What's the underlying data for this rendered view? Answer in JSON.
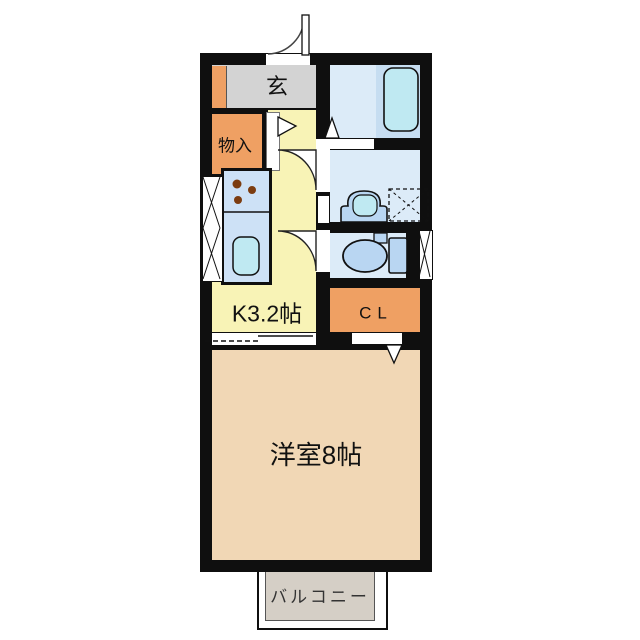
{
  "labels": {
    "genkan": "玄",
    "storage": "物入",
    "kitchen": "K3.2帖",
    "closet": "CL",
    "western_room": "洋室8帖",
    "balcony": "バルコニー"
  },
  "colors": {
    "wall": "#0f0f0f",
    "kitchen_floor": "#f8f3b6",
    "western_floor": "#f1d7b5",
    "orange": "#efa063",
    "genkan_gray": "#d3d3d3",
    "balcony_gray": "#d5cfc6",
    "wet_floor": "#dcebf8",
    "counter_blue": "#cde1f6",
    "tub_platform": "#c6ddf1",
    "cyan": "#bfe9f2",
    "fixture_blue": "#b9d6f2",
    "burner_brown": "#7c3c10",
    "outline": "#111111"
  },
  "fixtures": [
    "entrance-door",
    "shoe-cabinet",
    "storage-door",
    "kitchen-counter",
    "stove-burners",
    "kitchen-sink",
    "window",
    "bathtub",
    "folding-door",
    "washbasin",
    "washing-machine-pan",
    "toilet",
    "sliding-door",
    "closet-door"
  ]
}
